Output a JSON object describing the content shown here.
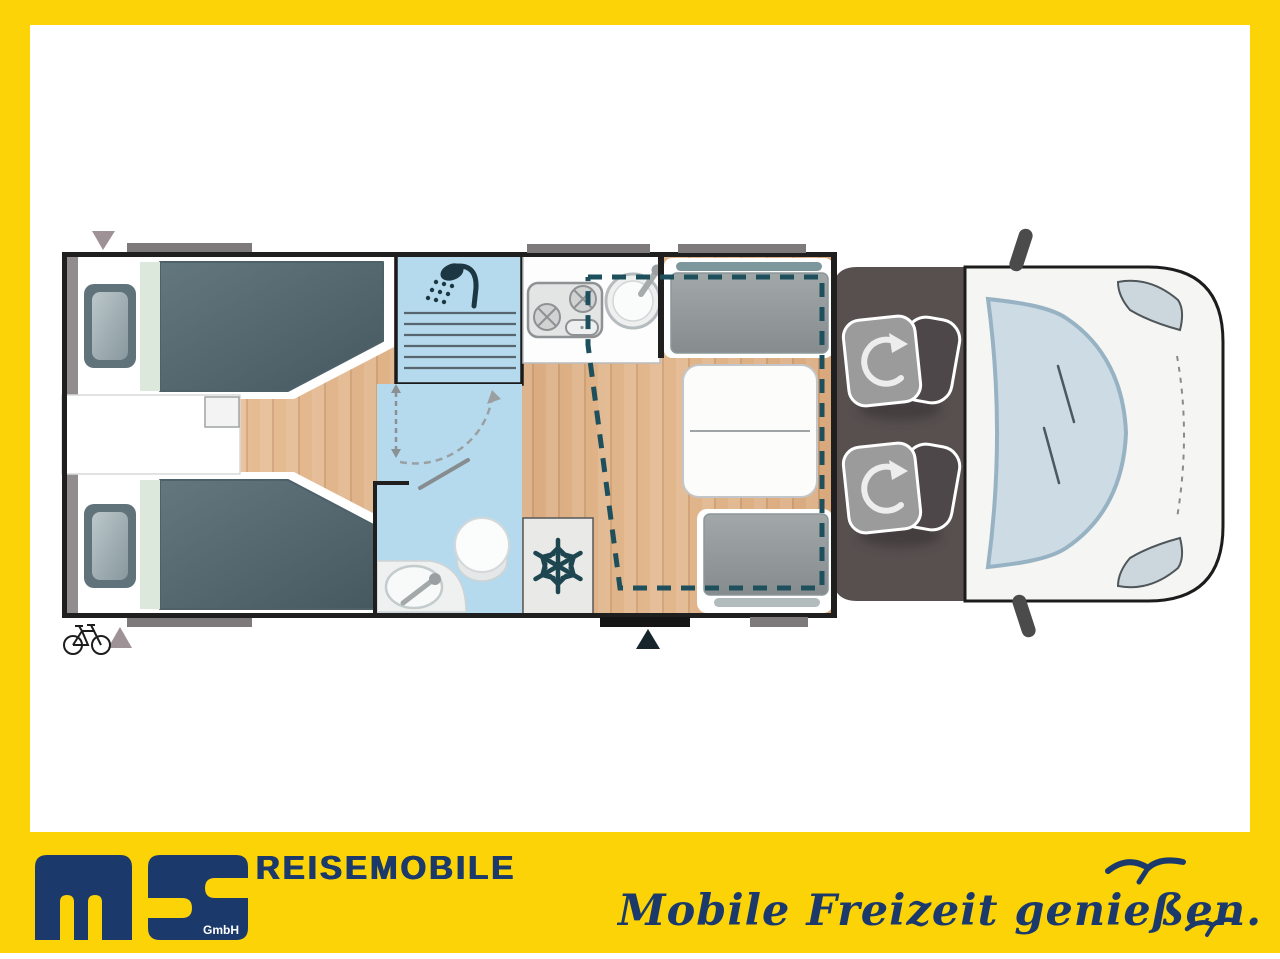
{
  "branding": {
    "wordmark": "REISEMOBILE",
    "logo_sub": "GmbH",
    "tagline": "Mobile Freizeit genießen.",
    "logo_letters": "ms",
    "brand_yellow": "#fcd307",
    "brand_navy": "#1b3a6b"
  },
  "floorplan": {
    "type": "motorhome-top-view",
    "colors": {
      "wall": "#1f1f1f",
      "wood_floor": "#dfb48a",
      "wet_room_blue": "#b5daed",
      "mattress_slate": "#56696f",
      "cab_floor": "#57504f",
      "vehicle_body": "#f5f5f3",
      "windshield": "#cddbe4",
      "drop_bed_dash": "#1d4f5c",
      "window_bar": "#7e7a7c"
    },
    "areas": [
      {
        "name": "rear-twin-beds",
        "items": [
          "bed-upper",
          "bed-lower",
          "nightstand"
        ]
      },
      {
        "name": "shower-cabin",
        "icon": "shower-icon"
      },
      {
        "name": "bathroom",
        "items": [
          "toilet",
          "washbasin",
          "door-swing-arc"
        ]
      },
      {
        "name": "kitchen",
        "items": [
          "two-burner-hob",
          "round-sink"
        ]
      },
      {
        "name": "fridge",
        "icon": "snowflake-icon"
      },
      {
        "name": "dinette",
        "items": [
          "bench-front",
          "table",
          "bench-rear",
          "drop-down-bed-outline"
        ]
      },
      {
        "name": "cab",
        "items": [
          "swivel-seat-driver",
          "swivel-seat-passenger",
          "windshield",
          "headlights",
          "mirrors"
        ]
      }
    ],
    "markers": [
      "rear-window-arrow-top",
      "rear-window-arrow-bottom",
      "entry-door-arrow",
      "bicycle-icon"
    ]
  }
}
